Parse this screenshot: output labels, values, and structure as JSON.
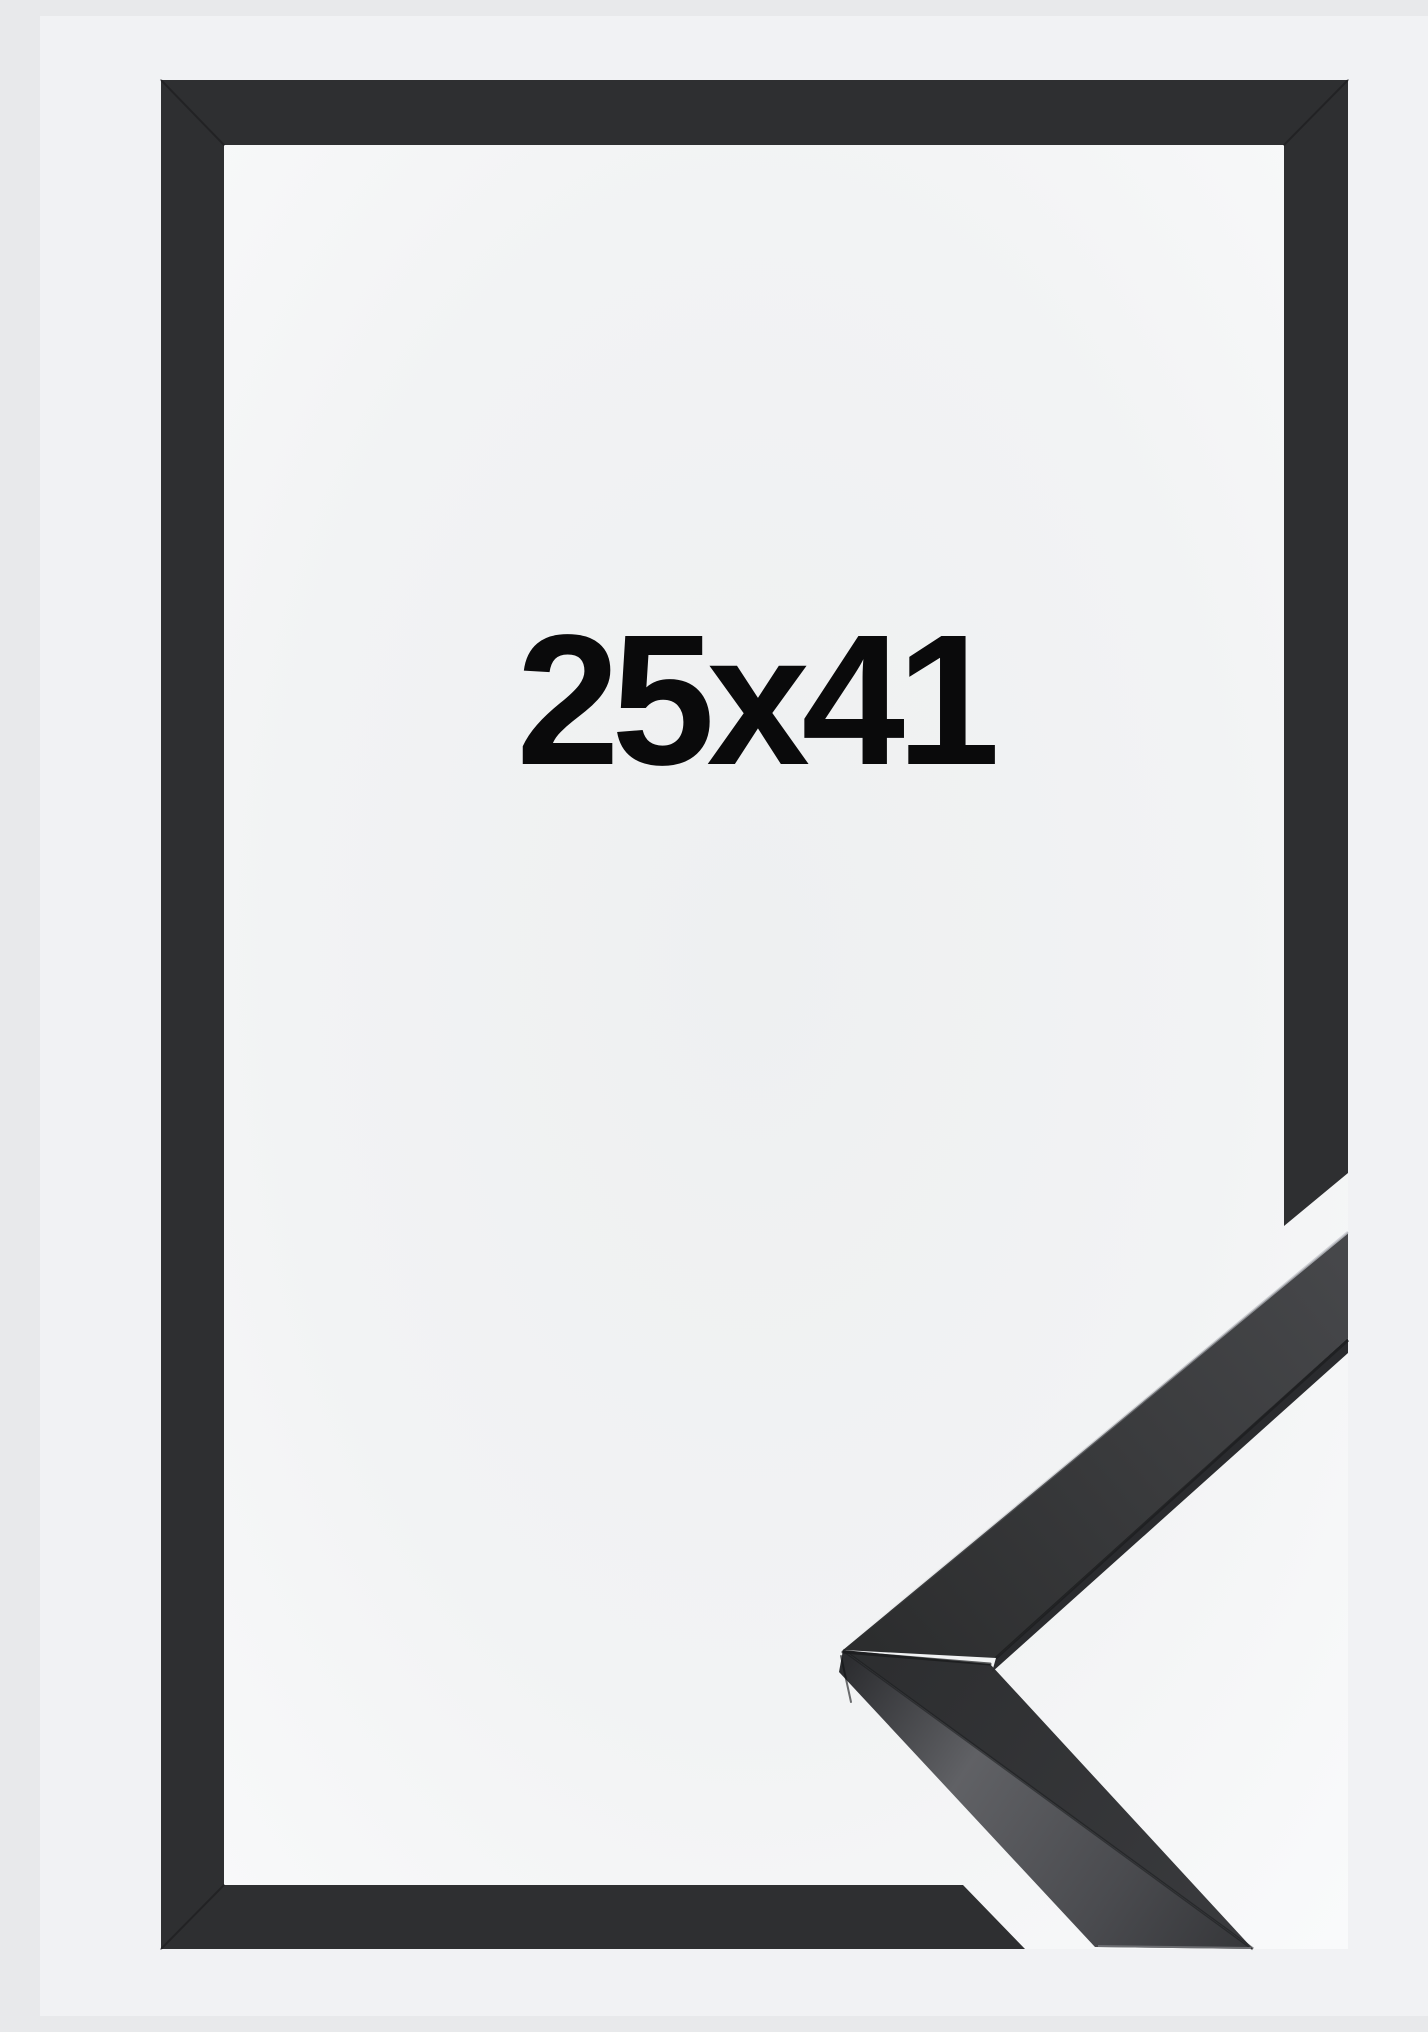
{
  "page": {
    "kind": "product-image",
    "subject": "black picture frame with corner profile sample"
  },
  "frame": {
    "size_label": "25x41",
    "colors": {
      "page_background": "#f1f2f4",
      "frame_moulding": "#2e2f31",
      "opening_white": "#f2f3f5",
      "sample_side_face_highlight": "#606165",
      "label_text": "#0a0a0b"
    }
  }
}
